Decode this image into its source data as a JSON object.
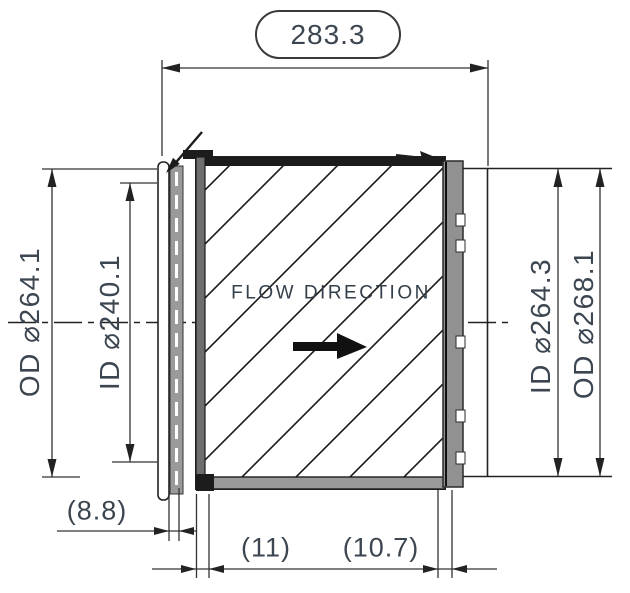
{
  "drawing": {
    "overall_length": "283.3",
    "left": {
      "outer_diameter": "OD ⌀264.1",
      "inner_diameter": "ID ⌀240.1"
    },
    "right": {
      "inner_diameter": "ID ⌀264.3",
      "outer_diameter": "OD ⌀268.1"
    },
    "bottom": {
      "left_offset": "(8.8)",
      "middle_offset": "(11)",
      "right_offset": "(10.7)"
    },
    "flow_label": "FLOW DIRECTION",
    "colors": {
      "line": "#222222",
      "dim_text": "#3c4650",
      "band_gray": "#919191",
      "background": "#ffffff"
    }
  }
}
